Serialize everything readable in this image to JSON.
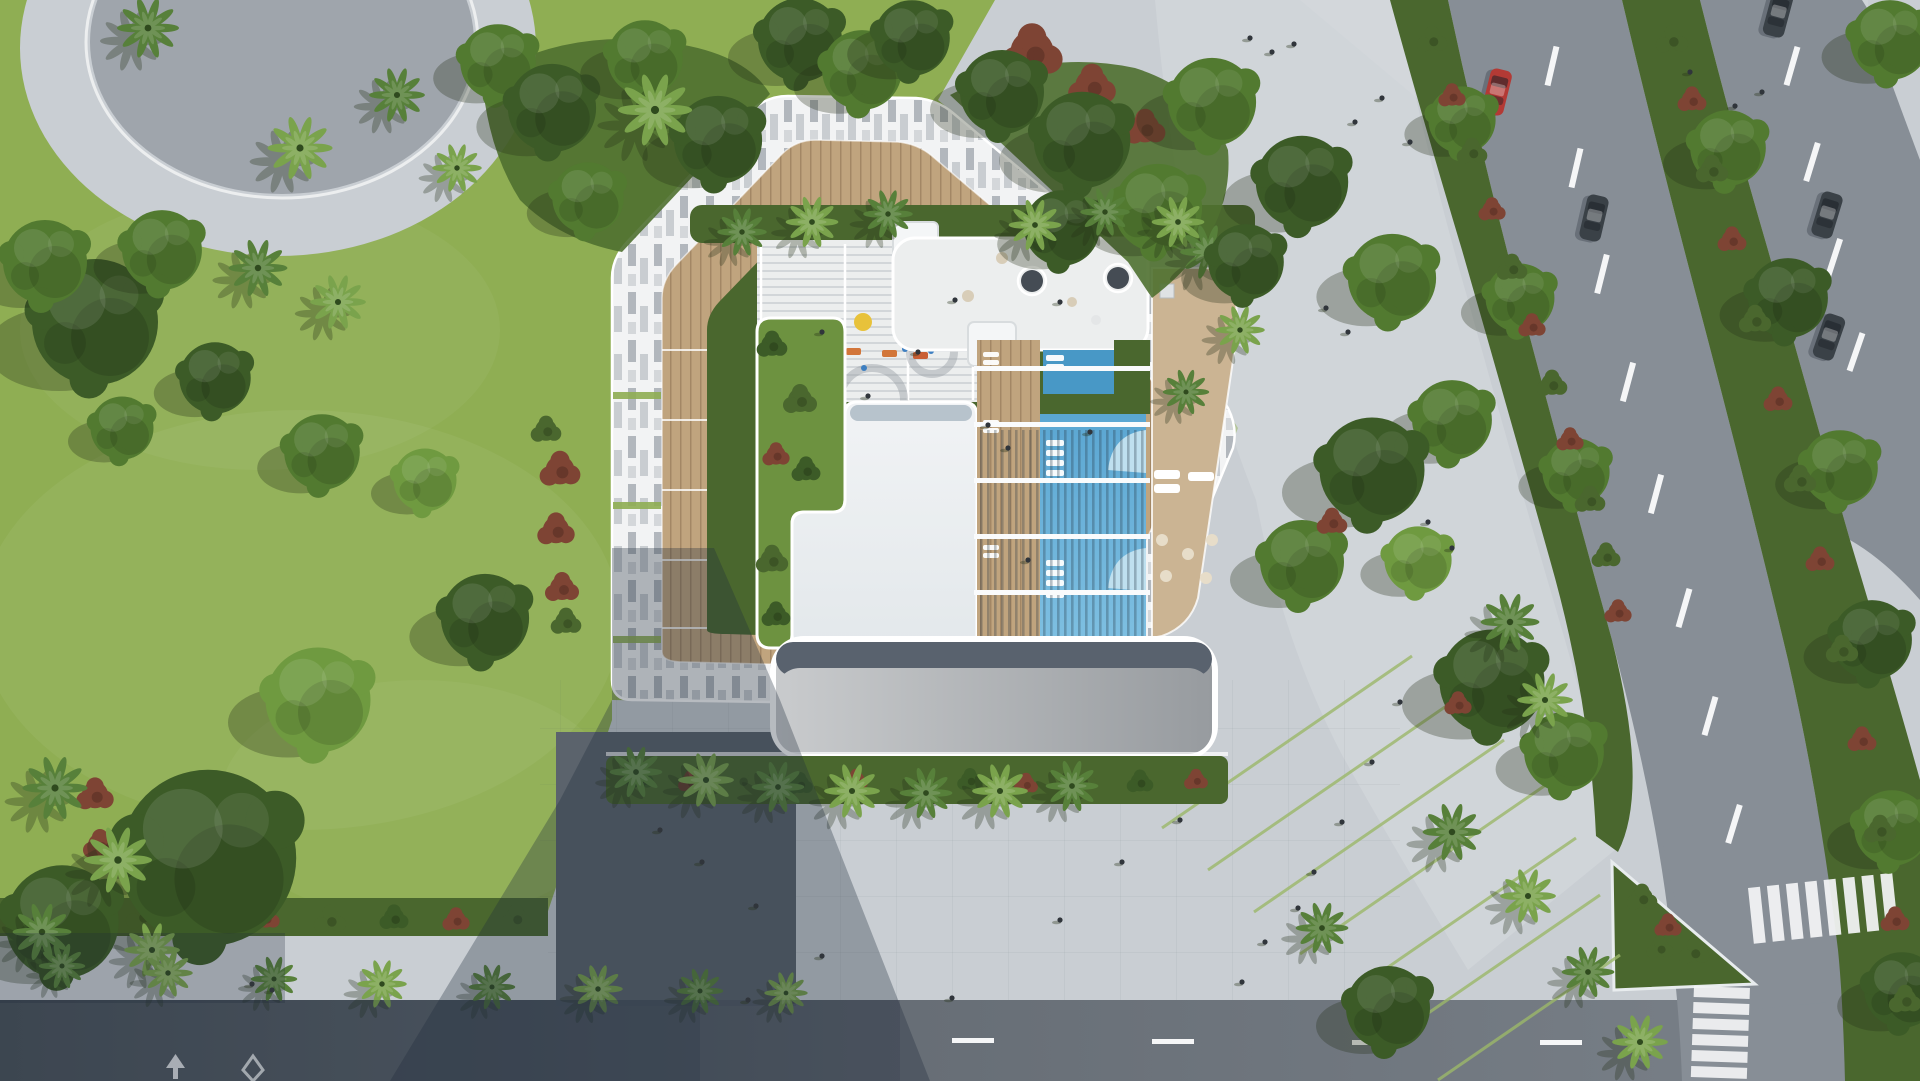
{
  "scene": {
    "type": "aerial-architectural-render",
    "description": "Top-down aerial rendering of a residential building with a rooftop amenity deck and pool, set between a landscaped park on the left and a tree-lined boulevard with pedestrian promenades on the right.",
    "features": [
      "park lawn with round trees, fan palms and red flowering shrubs",
      "oval paved plaza in the park",
      "building site ringed by piano-key patterned paving and wood decking",
      "rooftop garden, terraced white deck with playground, lounge terraces",
      "lap swimming pool with submerged loungers and pergola beams",
      "gray entrance canopy over a drop-off plaza",
      "boulevard with planted medians, dashed lane lines, cars",
      "zebra crosswalks, straight-arrow and diamond road markings",
      "pedestrians on promenades, plazas and the roof deck"
    ]
  },
  "colors": {
    "lawn": "#8fae53",
    "lawnLight": "#a6c066",
    "treeDark": "#3c5b27",
    "treeMid": "#527a30",
    "treeLight": "#6f9a40",
    "palm": "#57803a",
    "palmLight": "#7aa34c",
    "shrubRed": "#7e4434",
    "hedge": "#4a672e",
    "gardenGreen": "#6d9240",
    "bedGreen": "#4a672e",
    "paver": "#c9ced3",
    "paverLight": "#d8dce0",
    "pianoWhite": "#f2f3f4",
    "pianoGray": "#a7adb4",
    "wood": "#c0a47e",
    "woodDark": "#8a6f50",
    "deckWhite": "#eceeee",
    "deckLine": "#d2d6d9",
    "roofWhite": "#eef1f3",
    "roofEdge": "#a9b6c2",
    "canopy": "#a7aaae",
    "canopyDark": "#59626e",
    "poolBlue": "#5fa8d3",
    "poolDeep": "#4898c6",
    "poolLight": "#bfe0ef",
    "terraceTan": "#cbb493",
    "asphalt": "#878e96",
    "asphaltLight": "#9aa0a7",
    "roadShadow": "#4a525a",
    "marking": "#f5f6f7",
    "carRed": "#b33a35",
    "carDark": "#3a4147",
    "person": "#30353b",
    "shadow": "#1f2a3a"
  },
  "objects": {
    "vehicles": {
      "red_cars": 1,
      "dark_cars": 4
    },
    "pool": {
      "features": [
        "lap pool",
        "submerged loungers",
        "stepped entries",
        "pergola beams"
      ]
    },
    "road_markings": [
      "dashed lane lines",
      "zebra crosswalks",
      "straight arrow",
      "diamond"
    ],
    "crosswalks": 2,
    "medians_planted": 2,
    "entrance_canopy": 1,
    "oval_plaza": 1
  }
}
